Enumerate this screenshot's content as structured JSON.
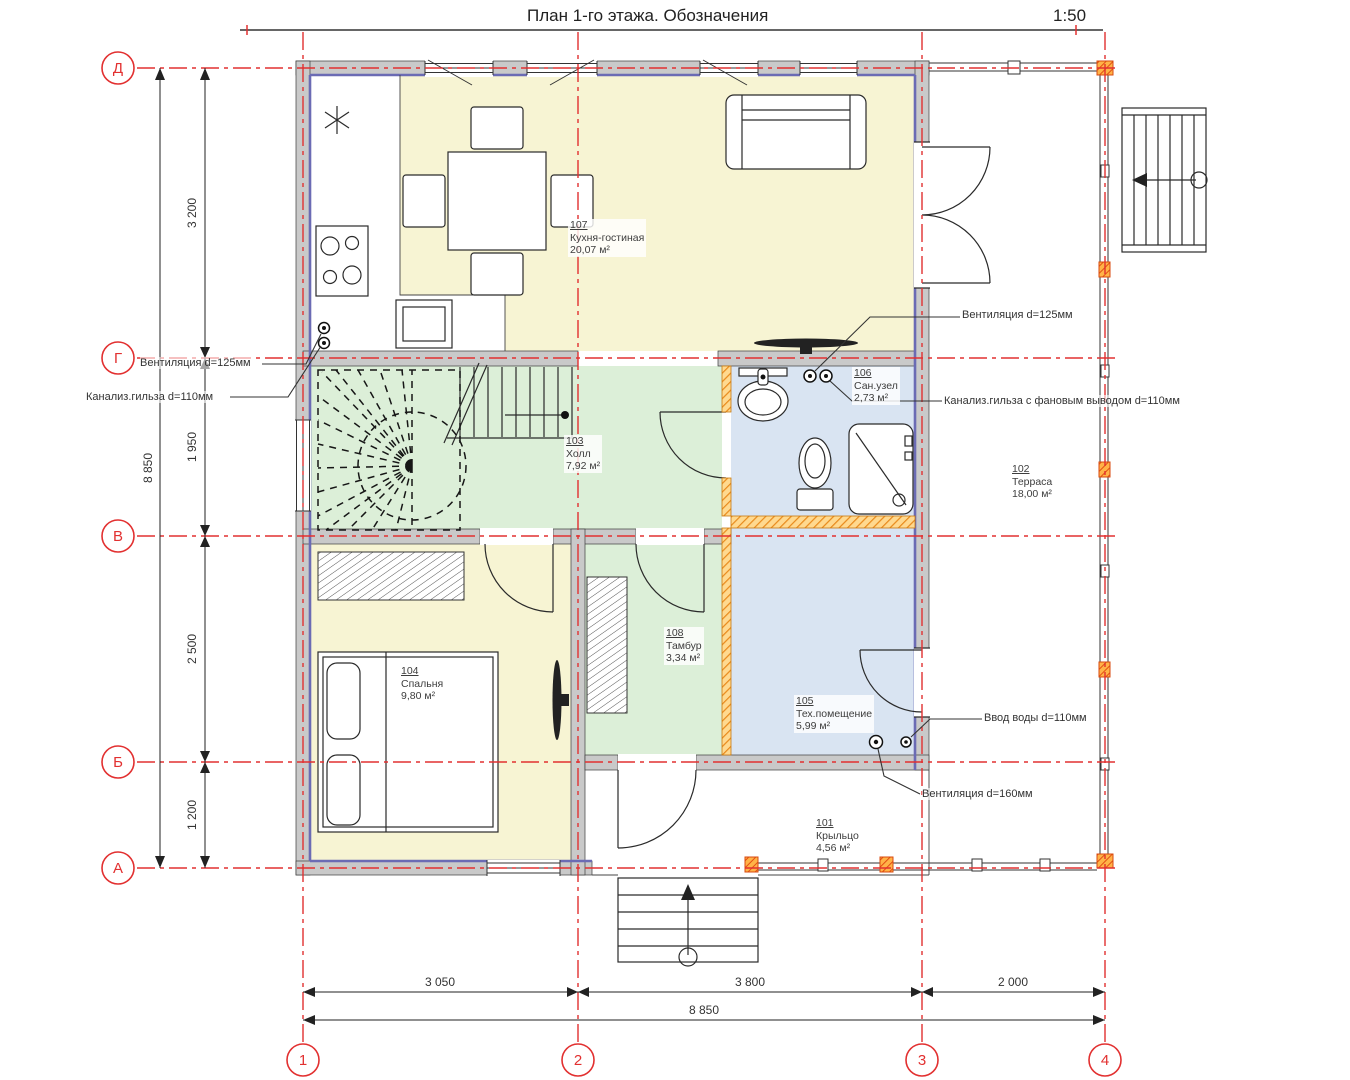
{
  "title": {
    "text": "План 1-го этажа. Обозначения",
    "scale": "1:50"
  },
  "axes": {
    "rows": [
      {
        "label": "Д"
      },
      {
        "label": "Г"
      },
      {
        "label": "В"
      },
      {
        "label": "Б"
      },
      {
        "label": "А"
      }
    ],
    "cols": [
      {
        "label": "1"
      },
      {
        "label": "2"
      },
      {
        "label": "3"
      },
      {
        "label": "4"
      }
    ]
  },
  "dimensions": {
    "left": {
      "segments": [
        "3 200",
        "1 950",
        "2 500",
        "1 200"
      ],
      "total": "8 850"
    },
    "bottom": {
      "segments": [
        "3 050",
        "3 800",
        "2 000"
      ],
      "total": "8 850"
    }
  },
  "rooms": [
    {
      "number": "101",
      "name": "Крыльцо",
      "area": "4,56 м²"
    },
    {
      "number": "102",
      "name": "Терраса",
      "area": "18,00 м²"
    },
    {
      "number": "103",
      "name": "Холл",
      "area": "7,92 м²"
    },
    {
      "number": "104",
      "name": "Спальня",
      "area": "9,80 м²"
    },
    {
      "number": "105",
      "name": "Тех.помещение",
      "area": "5,99 м²"
    },
    {
      "number": "106",
      "name": "Сан.узел",
      "area": "2,73 м²"
    },
    {
      "number": "107",
      "name": "Кухня-гостиная",
      "area": "20,07 м²"
    },
    {
      "number": "108",
      "name": "Тамбур",
      "area": "3,34 м²"
    }
  ],
  "annotations": {
    "vent125_left": "Вентиляция d=125мм",
    "sewer110_left": "Канализ.гильза d=110мм",
    "vent125_right": "Вентиляция d=125мм",
    "sewer110_right": "Канализ.гильза с фановым выводом d=110мм",
    "water110": "Ввод воды d=110мм",
    "vent160": "Вентиляция d=160мм"
  },
  "colors": {
    "axis_red": "#e23030",
    "wall_gray": "#c9c9c9",
    "floor_yellow": "#f7f4d3",
    "floor_green": "#dcefd8",
    "floor_blue": "#d9e4f2",
    "insulation_orange": "#e8921e",
    "lining_blue": "#6b6bb4"
  }
}
